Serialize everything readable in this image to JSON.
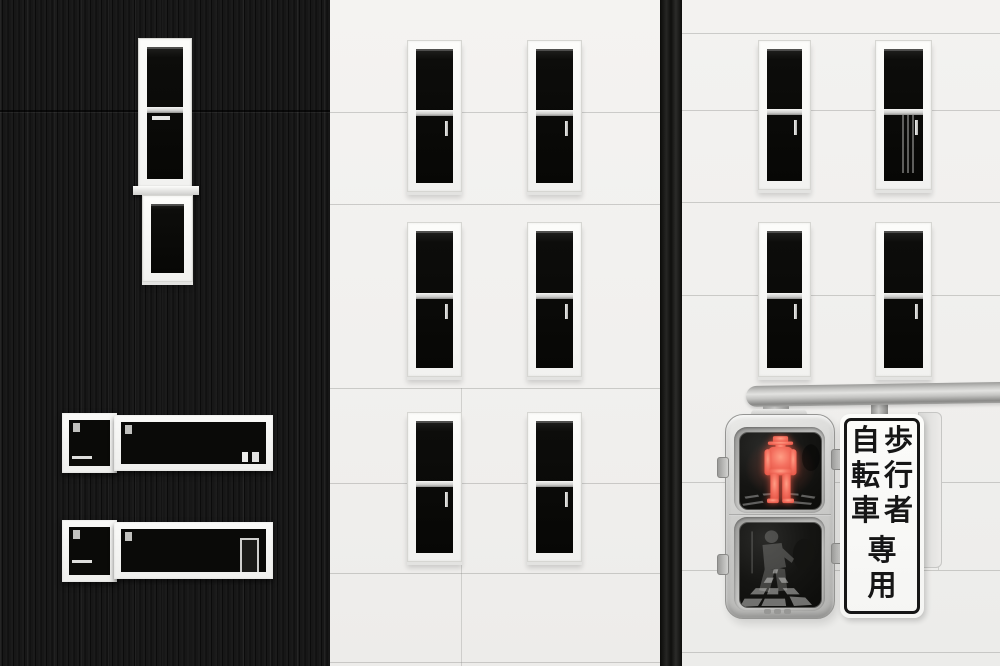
{
  "scene": {
    "description": "Black corrugated building facade beside white facades with dark sash windows; a Japanese pedestrian signal with a lit red standing figure hangs from a grey pole beside a vertical regulatory sign.",
    "signal_state": "red standing figure lit, lower walk lens dark"
  },
  "colors": {
    "accent_red": "#f4705f",
    "wall_white": "#f1f0ee",
    "facade_black": "#141414",
    "signal_grey": "#c6c6c4",
    "sign_text": "#161616"
  },
  "sign": {
    "text": "歩行者自転車専用",
    "right_column_chars": [
      "歩",
      "行",
      "者"
    ],
    "left_column_chars": [
      "自",
      "転",
      "車"
    ],
    "bottom_chars": [
      "専",
      "用"
    ]
  }
}
